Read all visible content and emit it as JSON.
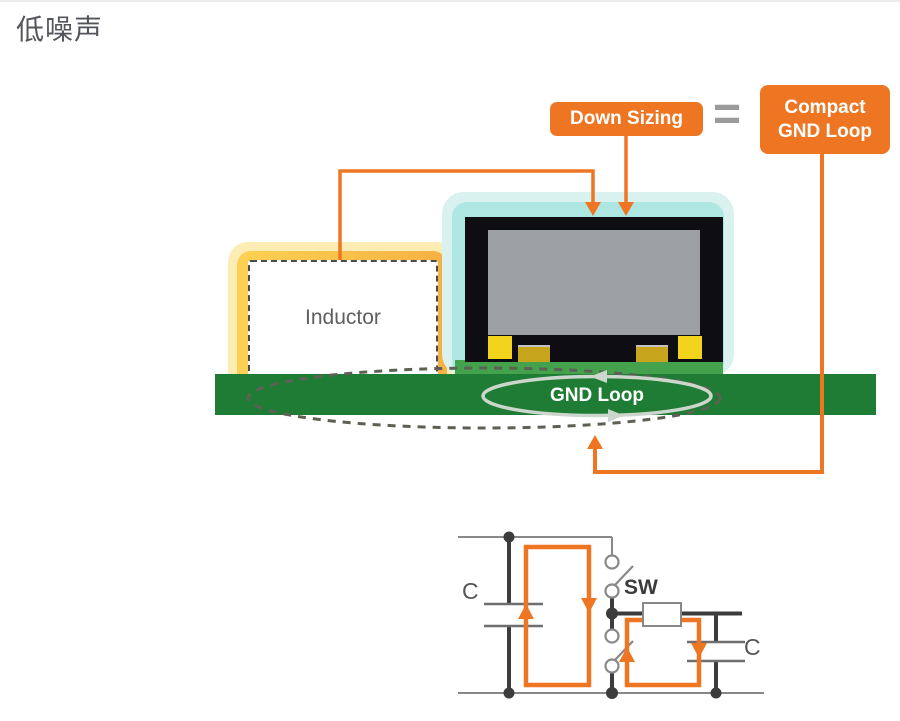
{
  "title": "低噪声",
  "annotation": {
    "down_sizing": "Down Sizing",
    "equals": "=",
    "compact_line1": "Compact",
    "compact_line2": "GND Loop"
  },
  "board": {
    "inductor_label": "Inductor",
    "gnd_loop_label": "GND Loop"
  },
  "circuit": {
    "cap_left": "C",
    "switch": "SW",
    "cap_right": "C"
  },
  "colors": {
    "orange": "#ee7623",
    "board_green": "#1e7c34",
    "board_green_light": "#44a14c",
    "chip_glow_outer": "#d9f2f0",
    "chip_glow_inner": "#aee6e2",
    "chip_body": "#0e0e12",
    "die_gray": "#9da0a2",
    "pad_yellow": "#f3d41c",
    "pad_gold": "#c7a51d",
    "inductor_glow_outer": "#fdecb4",
    "wire_gray": "#888888",
    "wire_dark": "#3c3c3c",
    "loop_stroke": "#ccd6cc",
    "dash_stroke": "#5c6154",
    "text_dark": "#53545c"
  }
}
